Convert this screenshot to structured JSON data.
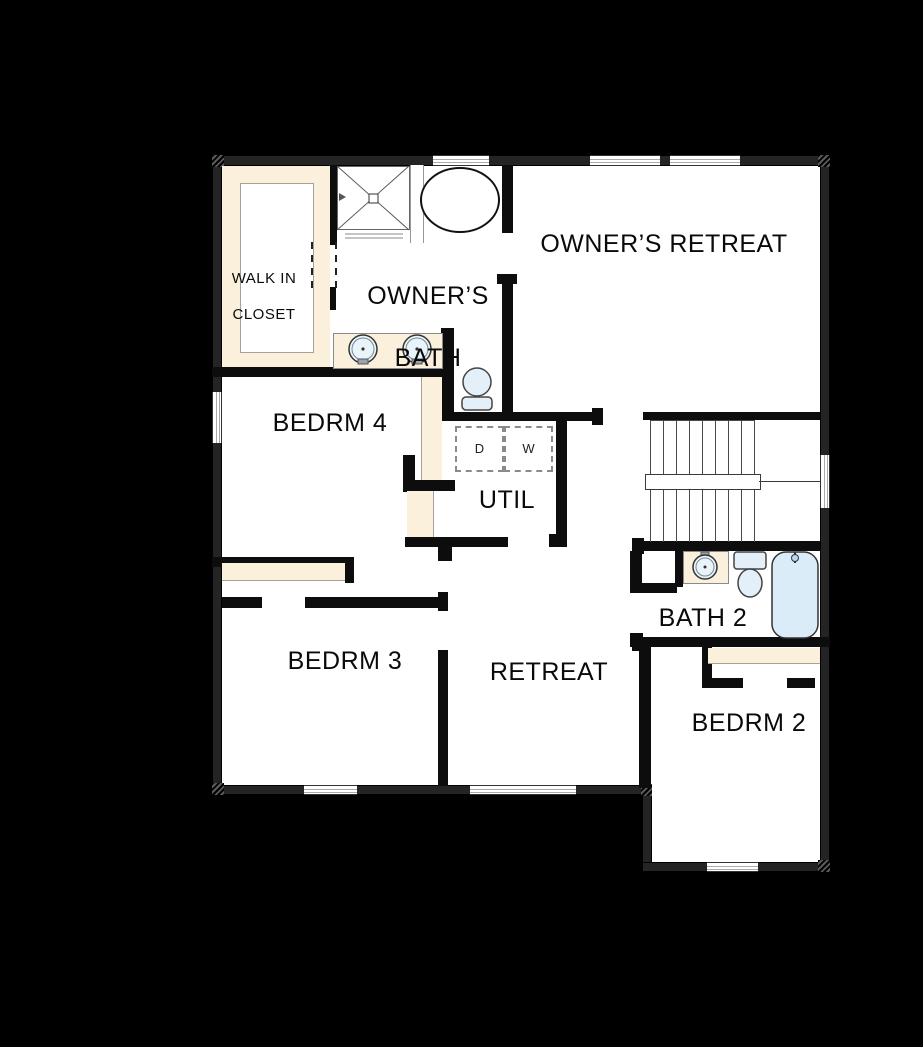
{
  "colors": {
    "background": "#000000",
    "floor": "#ffffff",
    "wall_interior": "#0d0d0d",
    "wall_exterior": "#242424",
    "shelf": "#faf0dc",
    "fixture": "#ddecf8"
  },
  "rooms": {
    "walk_in_closet": {
      "line1": "WALK IN",
      "line2": "CLOSET"
    },
    "owners_bath": {
      "line1": "OWNER’S",
      "line2": "BATH"
    },
    "owners_retreat": {
      "label": "OWNER’S RETREAT"
    },
    "bedrm4": {
      "label": "BEDRM 4"
    },
    "util": {
      "label": "UTIL"
    },
    "bath2": {
      "label": "BATH 2"
    },
    "bedrm3": {
      "label": "BEDRM 3"
    },
    "retreat": {
      "label": "RETREAT"
    },
    "bedrm2": {
      "label": "BEDRM 2"
    }
  },
  "appliances": {
    "dryer_label": "D",
    "washer_label": "W"
  }
}
